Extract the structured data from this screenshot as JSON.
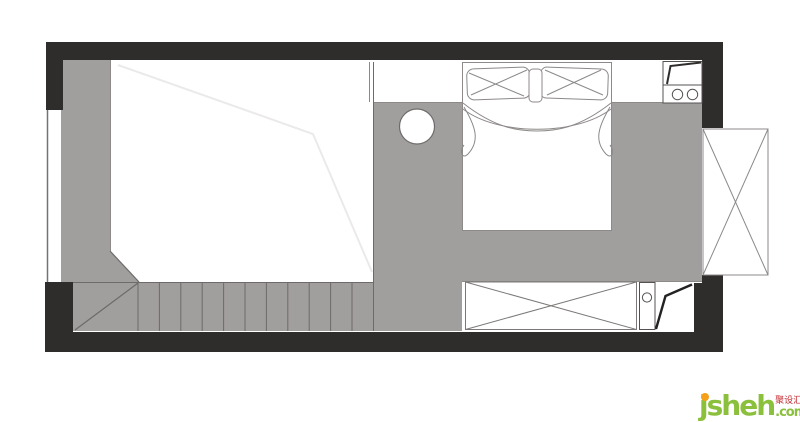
{
  "watermark": {
    "brand": "jsheh",
    "tld": ".com",
    "cn": "聚设汇"
  },
  "palette": {
    "wall_black": "#2f2c2c",
    "floor_gray": "#a19e9e",
    "edge_line": "#6e6a6a",
    "sketch_line": "#8d8989",
    "faint_loft_line": "#ebe9e9",
    "background": "#ffffff",
    "watermark_green": "#8bc03c",
    "watermark_orange": "#f5a019",
    "watermark_red": "#c1272d"
  },
  "stairs": {
    "tread_count": 11
  },
  "plan_elements": [
    "outer-walls",
    "left-window",
    "loft-platform-edge",
    "staircase",
    "corridor-floor",
    "double-bed",
    "round-table",
    "kitchen-unit-two-burners",
    "wardrobe-x",
    "shoe-cabinet",
    "entry-door",
    "balcony-cabinet-x"
  ]
}
